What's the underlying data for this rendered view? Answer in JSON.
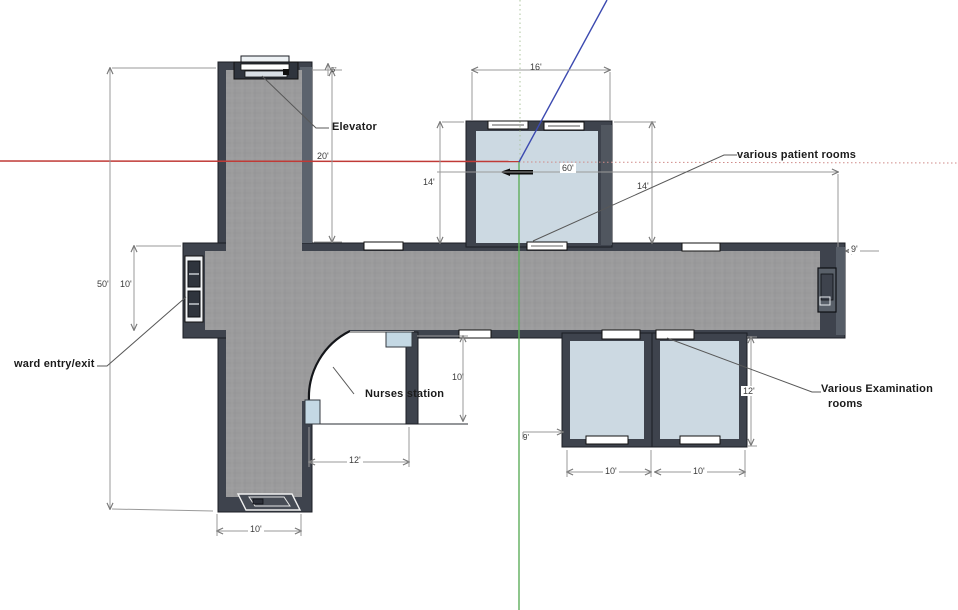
{
  "viewport": {
    "background": "#ffffff",
    "tool": "3d-floor-plan-view"
  },
  "axes": {
    "x_color": "#c03a36",
    "y_color": "#5fae5c",
    "z_color": "#3c4ab0"
  },
  "palette": {
    "wall": "#3e434d",
    "wall_light": "#5c636d",
    "floor": "#9b9b9c",
    "room_floor": "#ccd9e2",
    "counter": "#c4d8e4",
    "dim_line": "#999999",
    "label_text": "#1b1b1b"
  },
  "labels": {
    "elevator": "Elevator",
    "patient_rooms": "various patient rooms",
    "exam_rooms_line1": "Various Examination",
    "exam_rooms_line2": "rooms",
    "nurses_station": "Nurses station",
    "ward_entry": "ward entry/exit"
  },
  "dimensions": {
    "overall_height": "50'",
    "corridor_width": "10'",
    "elevator_wing_height": "20'",
    "elevator_top": "5'",
    "patient_room_width": "16'",
    "patient_room_depth_left": "14'",
    "patient_room_depth_right": "14'",
    "corridor_length": "60'",
    "corridor_end_width": "9'",
    "nurses_depth": "10'",
    "nurses_width": "12'",
    "leg_width": "10'",
    "exam_offset": "9'",
    "exam_room1_width": "10'",
    "exam_room2_width": "10'",
    "exam_room_depth": "12'"
  }
}
